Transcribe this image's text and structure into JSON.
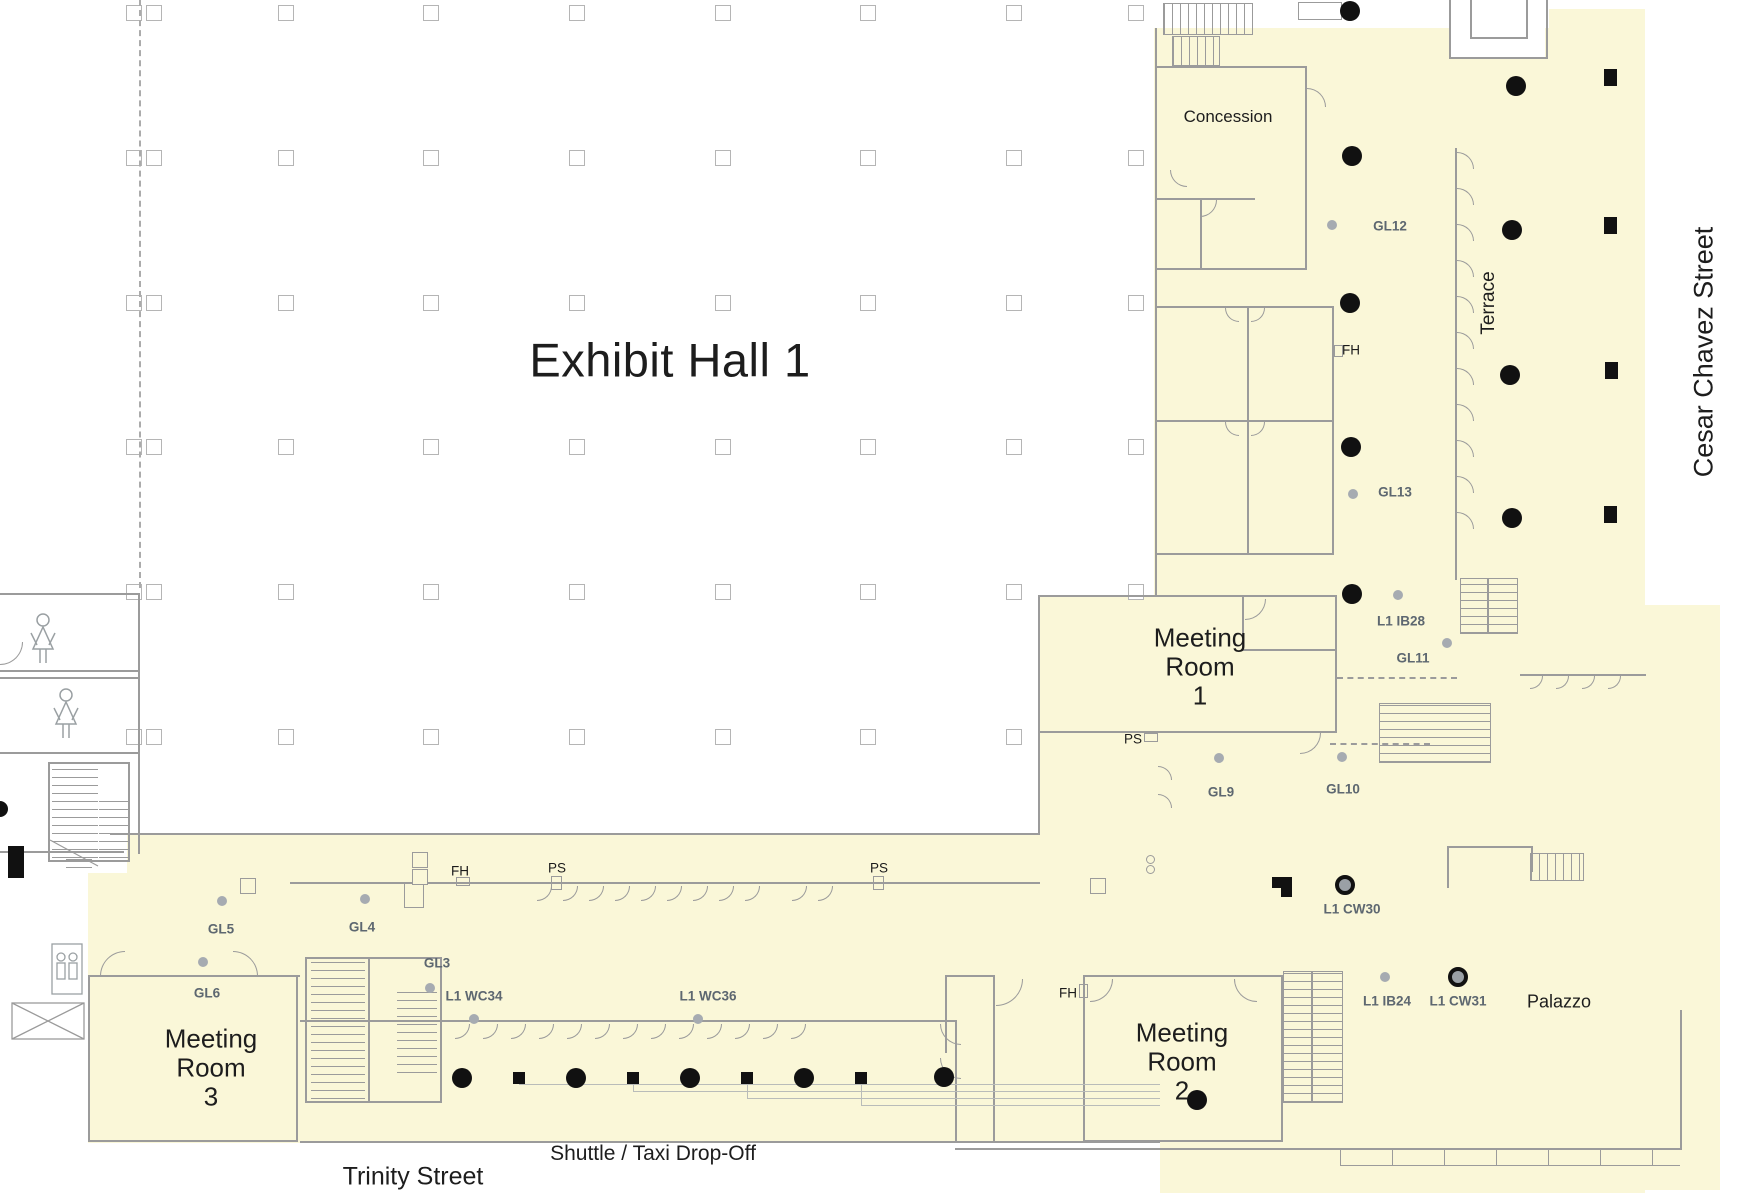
{
  "canvas": {
    "width": 1740,
    "height": 1200
  },
  "title": {
    "label": "Exhibit Hall 1"
  },
  "rooms": [
    {
      "id": "concession",
      "label": "Concession"
    },
    {
      "id": "meeting-room-1",
      "label": "Meeting Room 1",
      "lines": [
        "Meeting",
        "Room",
        "1"
      ]
    },
    {
      "id": "meeting-room-2",
      "label": "Meeting Room 2",
      "lines": [
        "Meeting",
        "Room",
        "2"
      ]
    },
    {
      "id": "meeting-room-3",
      "label": "Meeting Room 3",
      "lines": [
        "Meeting",
        "Room",
        "3"
      ]
    },
    {
      "id": "palazzo",
      "label": "Palazzo"
    },
    {
      "id": "terrace",
      "label": "Terrace"
    }
  ],
  "streets": [
    {
      "id": "cesar-chavez-street",
      "label": "Cesar Chavez Street"
    },
    {
      "id": "trinity-street",
      "label": "Trinity Street"
    },
    {
      "id": "shuttle-taxi-drop-off",
      "label": "Shuttle / Taxi Drop-Off"
    }
  ],
  "markers": [
    {
      "id": "gl12",
      "label": "GL12",
      "kind": "guideline"
    },
    {
      "id": "gl13",
      "label": "GL13",
      "kind": "guideline"
    },
    {
      "id": "l1-ib28",
      "label": "L1 IB28",
      "kind": "guideline"
    },
    {
      "id": "gl11",
      "label": "GL11",
      "kind": "guideline"
    },
    {
      "id": "gl9",
      "label": "GL9",
      "kind": "guideline"
    },
    {
      "id": "gl10",
      "label": "GL10",
      "kind": "guideline"
    },
    {
      "id": "l1-cw30",
      "label": "L1 CW30",
      "kind": "guideline"
    },
    {
      "id": "l1-ib24",
      "label": "L1 IB24",
      "kind": "guideline"
    },
    {
      "id": "l1-cw31",
      "label": "L1 CW31",
      "kind": "guideline"
    },
    {
      "id": "gl5",
      "label": "GL5",
      "kind": "guideline"
    },
    {
      "id": "gl4",
      "label": "GL4",
      "kind": "guideline"
    },
    {
      "id": "gl3",
      "label": "GL3",
      "kind": "guideline"
    },
    {
      "id": "l1-wc34",
      "label": "L1 WC34",
      "kind": "guideline"
    },
    {
      "id": "l1-wc36",
      "label": "L1 WC36",
      "kind": "guideline"
    },
    {
      "id": "gl6",
      "label": "GL6",
      "kind": "guideline"
    },
    {
      "id": "fh-upper",
      "label": "FH",
      "kind": "callout"
    },
    {
      "id": "fh-left",
      "label": "FH",
      "kind": "callout"
    },
    {
      "id": "fh-mr2",
      "label": "FH",
      "kind": "callout"
    },
    {
      "id": "ps-mr1",
      "label": "PS",
      "kind": "callout"
    },
    {
      "id": "ps-left",
      "label": "PS",
      "kind": "callout"
    },
    {
      "id": "ps-mid",
      "label": "PS",
      "kind": "callout"
    }
  ],
  "colors": {
    "highlight": "#FAF7D8",
    "wall": "#9b9b9b",
    "marker_text": "#5d6770",
    "column_black": "#111111",
    "marker_dot": "#a6abb1"
  }
}
